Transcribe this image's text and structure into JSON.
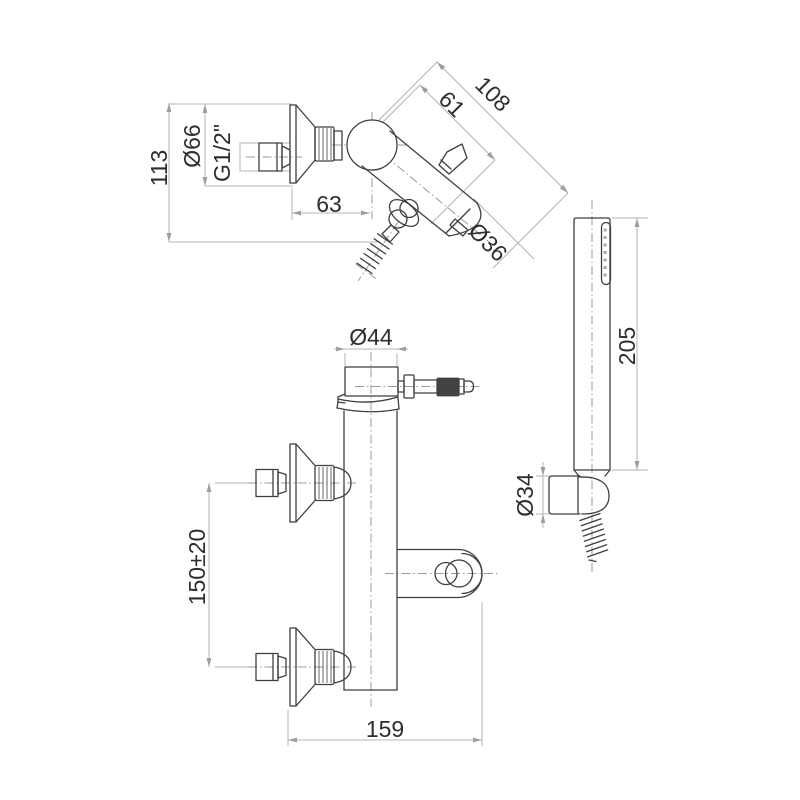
{
  "drawing": {
    "background_color": "#ffffff",
    "outline_color": "#3f3f3f",
    "dimension_line_color": "#b4b4b4",
    "centerline_color": "#9b9b9b",
    "text_color": "#2d2d2d",
    "side_view": {
      "dims": {
        "height": "113",
        "flange_diameter": "Ø66",
        "thread_size": "G1/2\"",
        "wall_to_center": "63",
        "center_to_handle": "61",
        "depth": "108",
        "spout_diameter": "Ø36"
      }
    },
    "hand_shower_view": {
      "dims": {
        "handle_length": "205",
        "holder_diameter": "Ø34"
      }
    },
    "front_view": {
      "dims": {
        "body_diameter": "Ø44",
        "inlet_spacing": "150±20",
        "overall_width": "159"
      }
    }
  }
}
